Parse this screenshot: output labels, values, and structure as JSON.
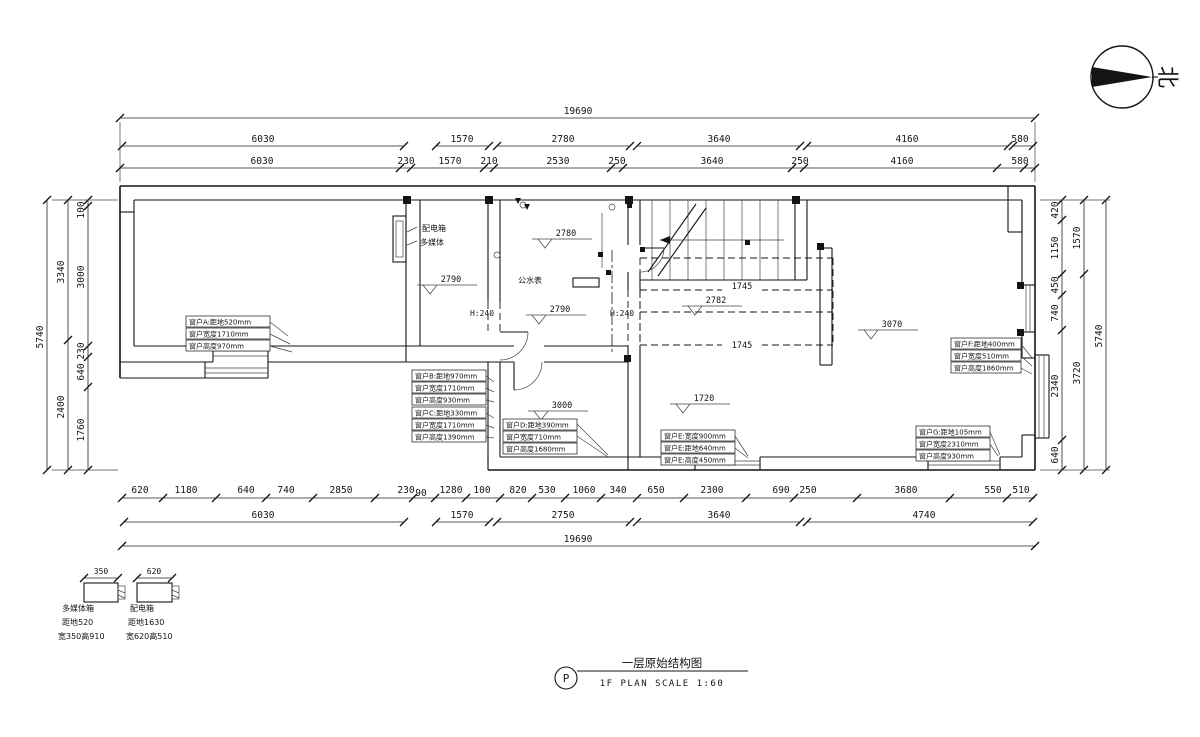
{
  "dims": {
    "t1": [
      "19690"
    ],
    "t2": [
      "6030",
      "1570",
      "2780",
      "3640",
      "4160",
      "580"
    ],
    "t3": [
      "6030",
      "230",
      "1570",
      "210",
      "2530",
      "250",
      "3640",
      "250",
      "4160",
      "580"
    ],
    "b1": [
      "620",
      "1180",
      "640",
      "740",
      "2850",
      "230",
      "90",
      "1280",
      "100",
      "820",
      "530",
      "1060",
      "340",
      "650",
      "2300",
      "690",
      "250",
      "3680",
      "550",
      "510"
    ],
    "b2": [
      "6030",
      "1570",
      "2750",
      "3640",
      "4740"
    ],
    "b3": [
      "19690"
    ],
    "l1": [
      "5740"
    ],
    "l2": [
      "3340",
      "2400"
    ],
    "l3": [
      "100",
      "3000",
      "230",
      "640",
      "1760"
    ],
    "r1": [
      "420",
      "1150",
      "450",
      "740",
      "2340",
      "640"
    ],
    "r2": [
      "1570",
      "3720"
    ],
    "r3": [
      "5740"
    ]
  },
  "levels": [
    "2780",
    "2790",
    "2790",
    "2782",
    "1720",
    "3000",
    "3070"
  ],
  "beams": [
    "1745",
    "1745"
  ],
  "rooms": {
    "water_meter": "公水表",
    "dist_box": "配电箱",
    "multimedia": "多媒体",
    "h1": "H:240",
    "h2": "H:240"
  },
  "annos": {
    "a": [
      "窗户A:距地520mm",
      "窗户宽度1710mm",
      "窗户高度970mm"
    ],
    "b": [
      "窗户B:距地970mm",
      "窗户宽度1710mm",
      "窗户高度930mm"
    ],
    "c": [
      "窗户C:距地330mm",
      "窗户宽度1710mm",
      "窗户高度1390mm"
    ],
    "d": [
      "窗户D:距地390mm",
      "窗户宽度710mm",
      "窗户高度1680mm"
    ],
    "e": [
      "窗户E:宽度900mm",
      "窗户E:距地640mm",
      "窗户E:高度450mm"
    ],
    "f": [
      "窗户F:距地400mm",
      "窗户宽度510mm",
      "窗户高度1860mm"
    ],
    "g": [
      "窗户G:距地105mm",
      "窗户宽度2310mm",
      "窗户高度930mm"
    ]
  },
  "legend": {
    "i1": {
      "dim": "350",
      "lines": [
        "多媒体箱",
        "距地520",
        "宽350高910"
      ]
    },
    "i2": {
      "dim": "620",
      "lines": [
        "配电箱",
        "距地1630",
        "宽620高510"
      ]
    }
  },
  "titleblock": {
    "bubble": "P",
    "title": "一层原始结构图",
    "subtitle": "1F PLAN   SCALE  1:60"
  },
  "compass": {
    "label": "北"
  }
}
